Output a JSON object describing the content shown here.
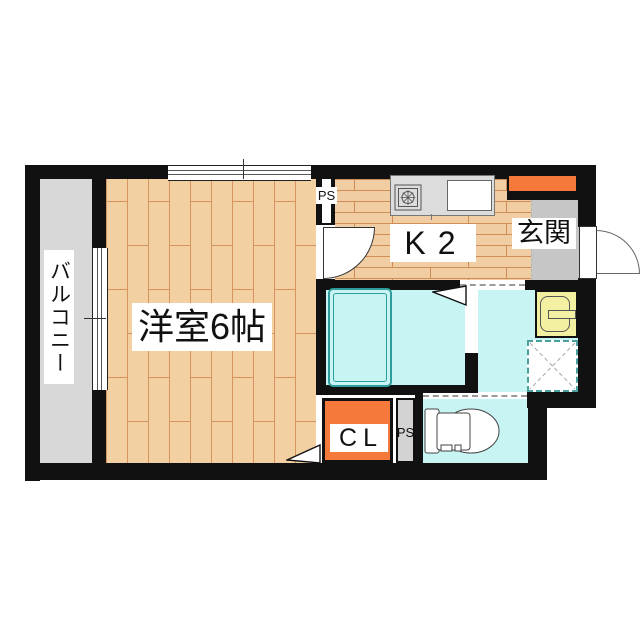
{
  "floorplan": {
    "title": "1K apartment floor plan",
    "rooms": {
      "balcony": {
        "label": "バルコニー"
      },
      "western_room": {
        "label": "洋室6帖"
      },
      "kitchen": {
        "label": "K2"
      },
      "entrance": {
        "label": "玄関"
      },
      "closet": {
        "label": "CL"
      },
      "pipe_space_top": {
        "label": "PS"
      },
      "pipe_space_bottom": {
        "label": "PS"
      }
    },
    "fixtures": {
      "kitchen_counter": "counter-with-stove-and-sink",
      "stove_icon": "gas-burner-icon",
      "kitchen_sink": "sink-basin",
      "bathtub": "bathtub",
      "vanity": "wash-basin-unit",
      "washer_pan": "washing-machine-pan",
      "toilet_icon": "toilet",
      "shoe_cabinet": "shoe-cabinet",
      "folding_door_bath": "folding-door-triangle",
      "folding_door_closet": "folding-door-triangle",
      "window_top": "double-sash-window",
      "window_balcony": "sliding-glass-door",
      "door_kitchen": "swing-door-arc",
      "door_entrance": "swing-door-arc"
    },
    "colors": {
      "wall": "#111111",
      "wood_floor": "#f2d0a2",
      "wood_line": "#d5945e",
      "water_area": "#c9f4f4",
      "tub_line": "#2e9c9c",
      "accent_orange": "#f5793b",
      "balcony_gray": "#d8d8d8",
      "entrance_gray": "#c6c6c6",
      "counter_gray": "#dcdcdc",
      "vanity_yellow": "#f4f0a2"
    }
  }
}
